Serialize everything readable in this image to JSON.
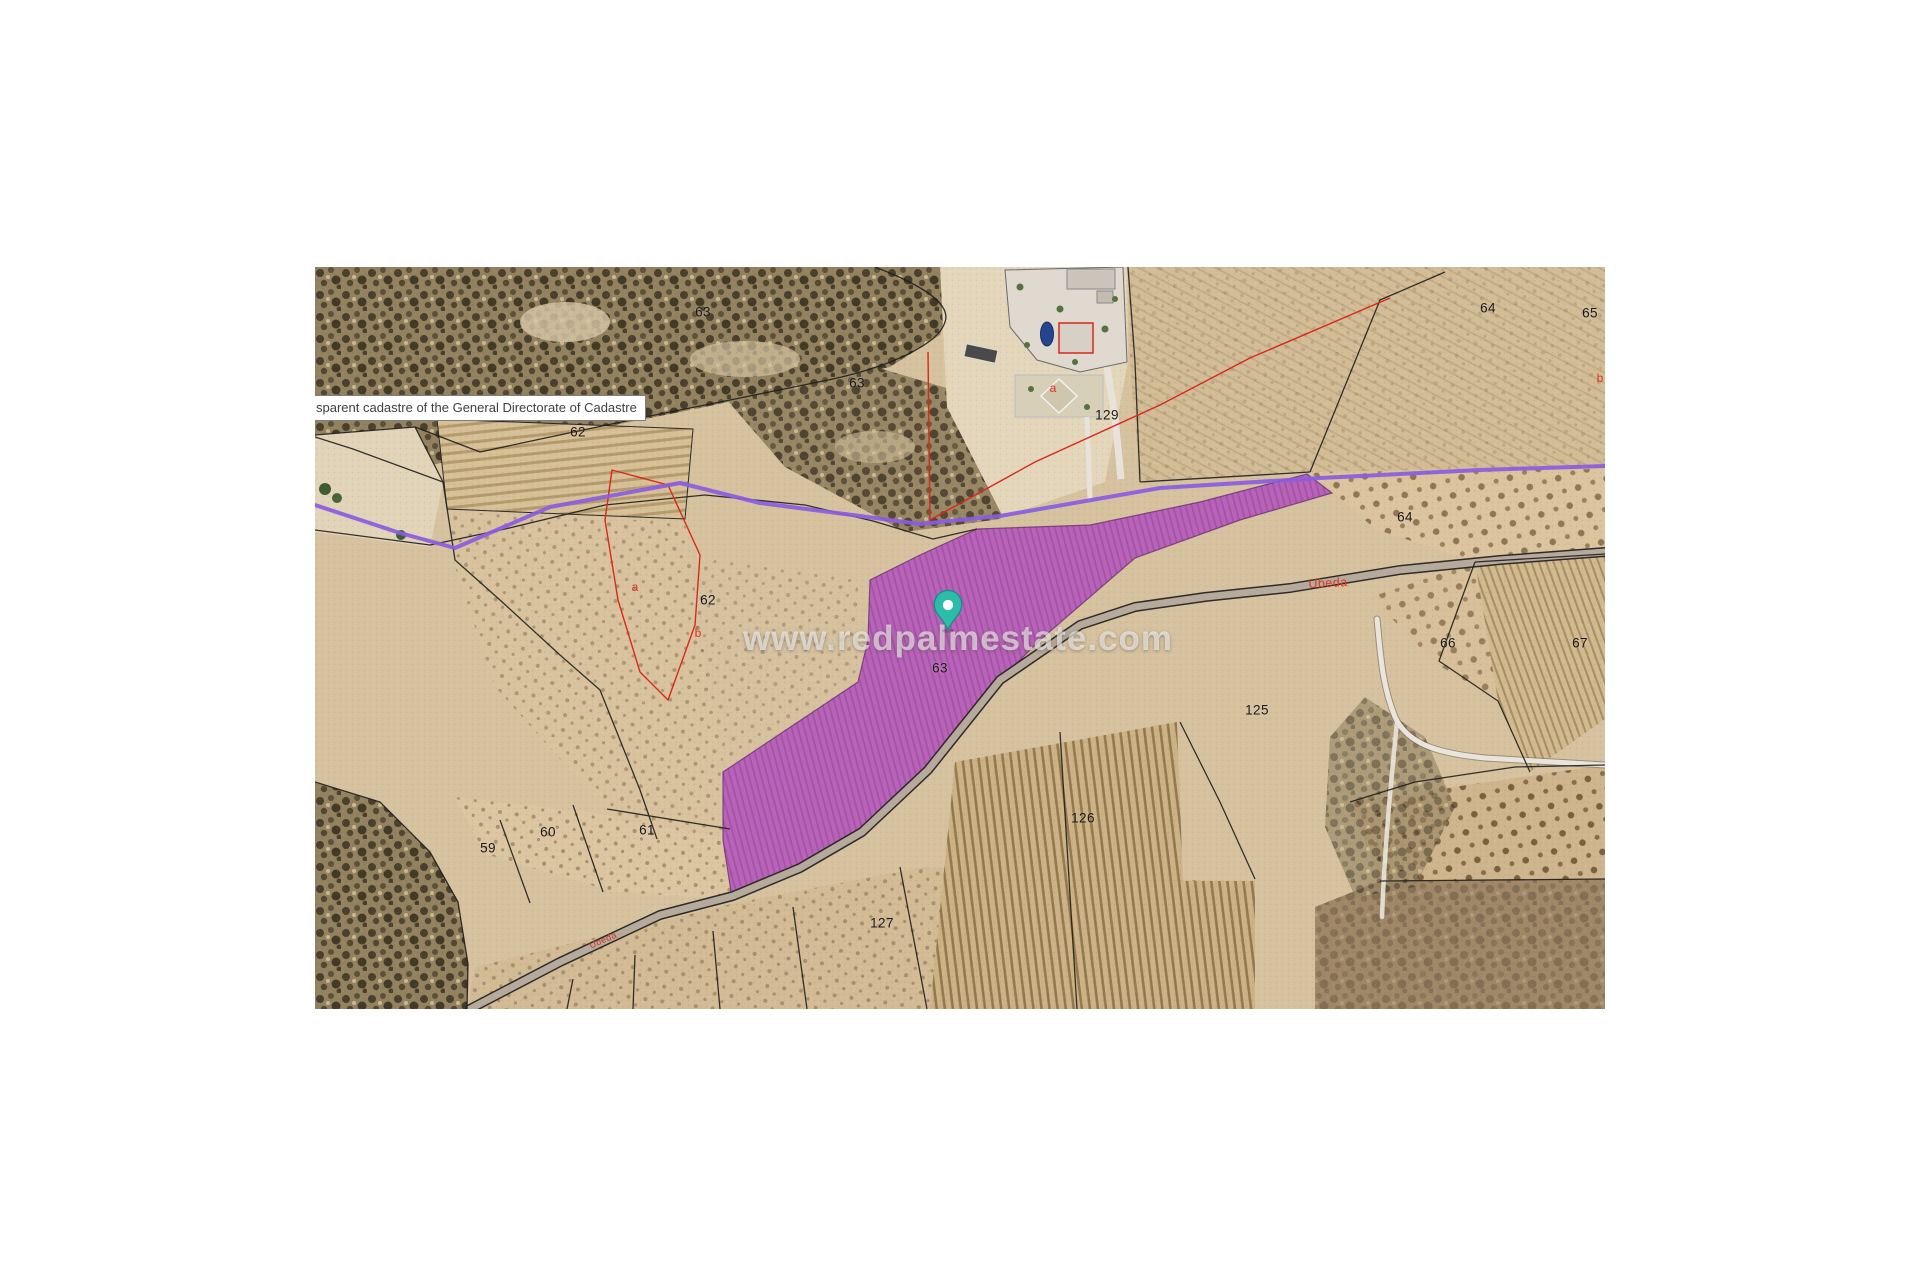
{
  "map": {
    "attribution": "sparent cadastre of the General Directorate of Cadastre",
    "watermark": "www.redpalmestate.com",
    "colors": {
      "highlight_parcel": "#b455bc",
      "gps_track_line": "#8a5ce0",
      "cadastral_red_line": "#da281b",
      "boundary_line": "#1f1f1f",
      "pin_teal": "#2cbcaa",
      "road_gray": "#b6aa9c"
    },
    "parcel_numbers": [
      {
        "text": "63"
      },
      {
        "text": "62"
      },
      {
        "text": "63"
      },
      {
        "text": "129"
      },
      {
        "text": "64"
      },
      {
        "text": "65"
      },
      {
        "text": "64"
      },
      {
        "text": "62"
      },
      {
        "text": "63"
      },
      {
        "text": "66"
      },
      {
        "text": "67"
      },
      {
        "text": "125"
      },
      {
        "text": "126"
      },
      {
        "text": "127"
      },
      {
        "text": "59"
      },
      {
        "text": "60"
      },
      {
        "text": "61"
      }
    ],
    "red_annotations": [
      {
        "text": "a"
      },
      {
        "text": "a"
      },
      {
        "text": "b"
      },
      {
        "text": "b"
      }
    ],
    "road_names": [
      {
        "text": "Ubeda"
      },
      {
        "text": "Ubeda"
      }
    ]
  }
}
